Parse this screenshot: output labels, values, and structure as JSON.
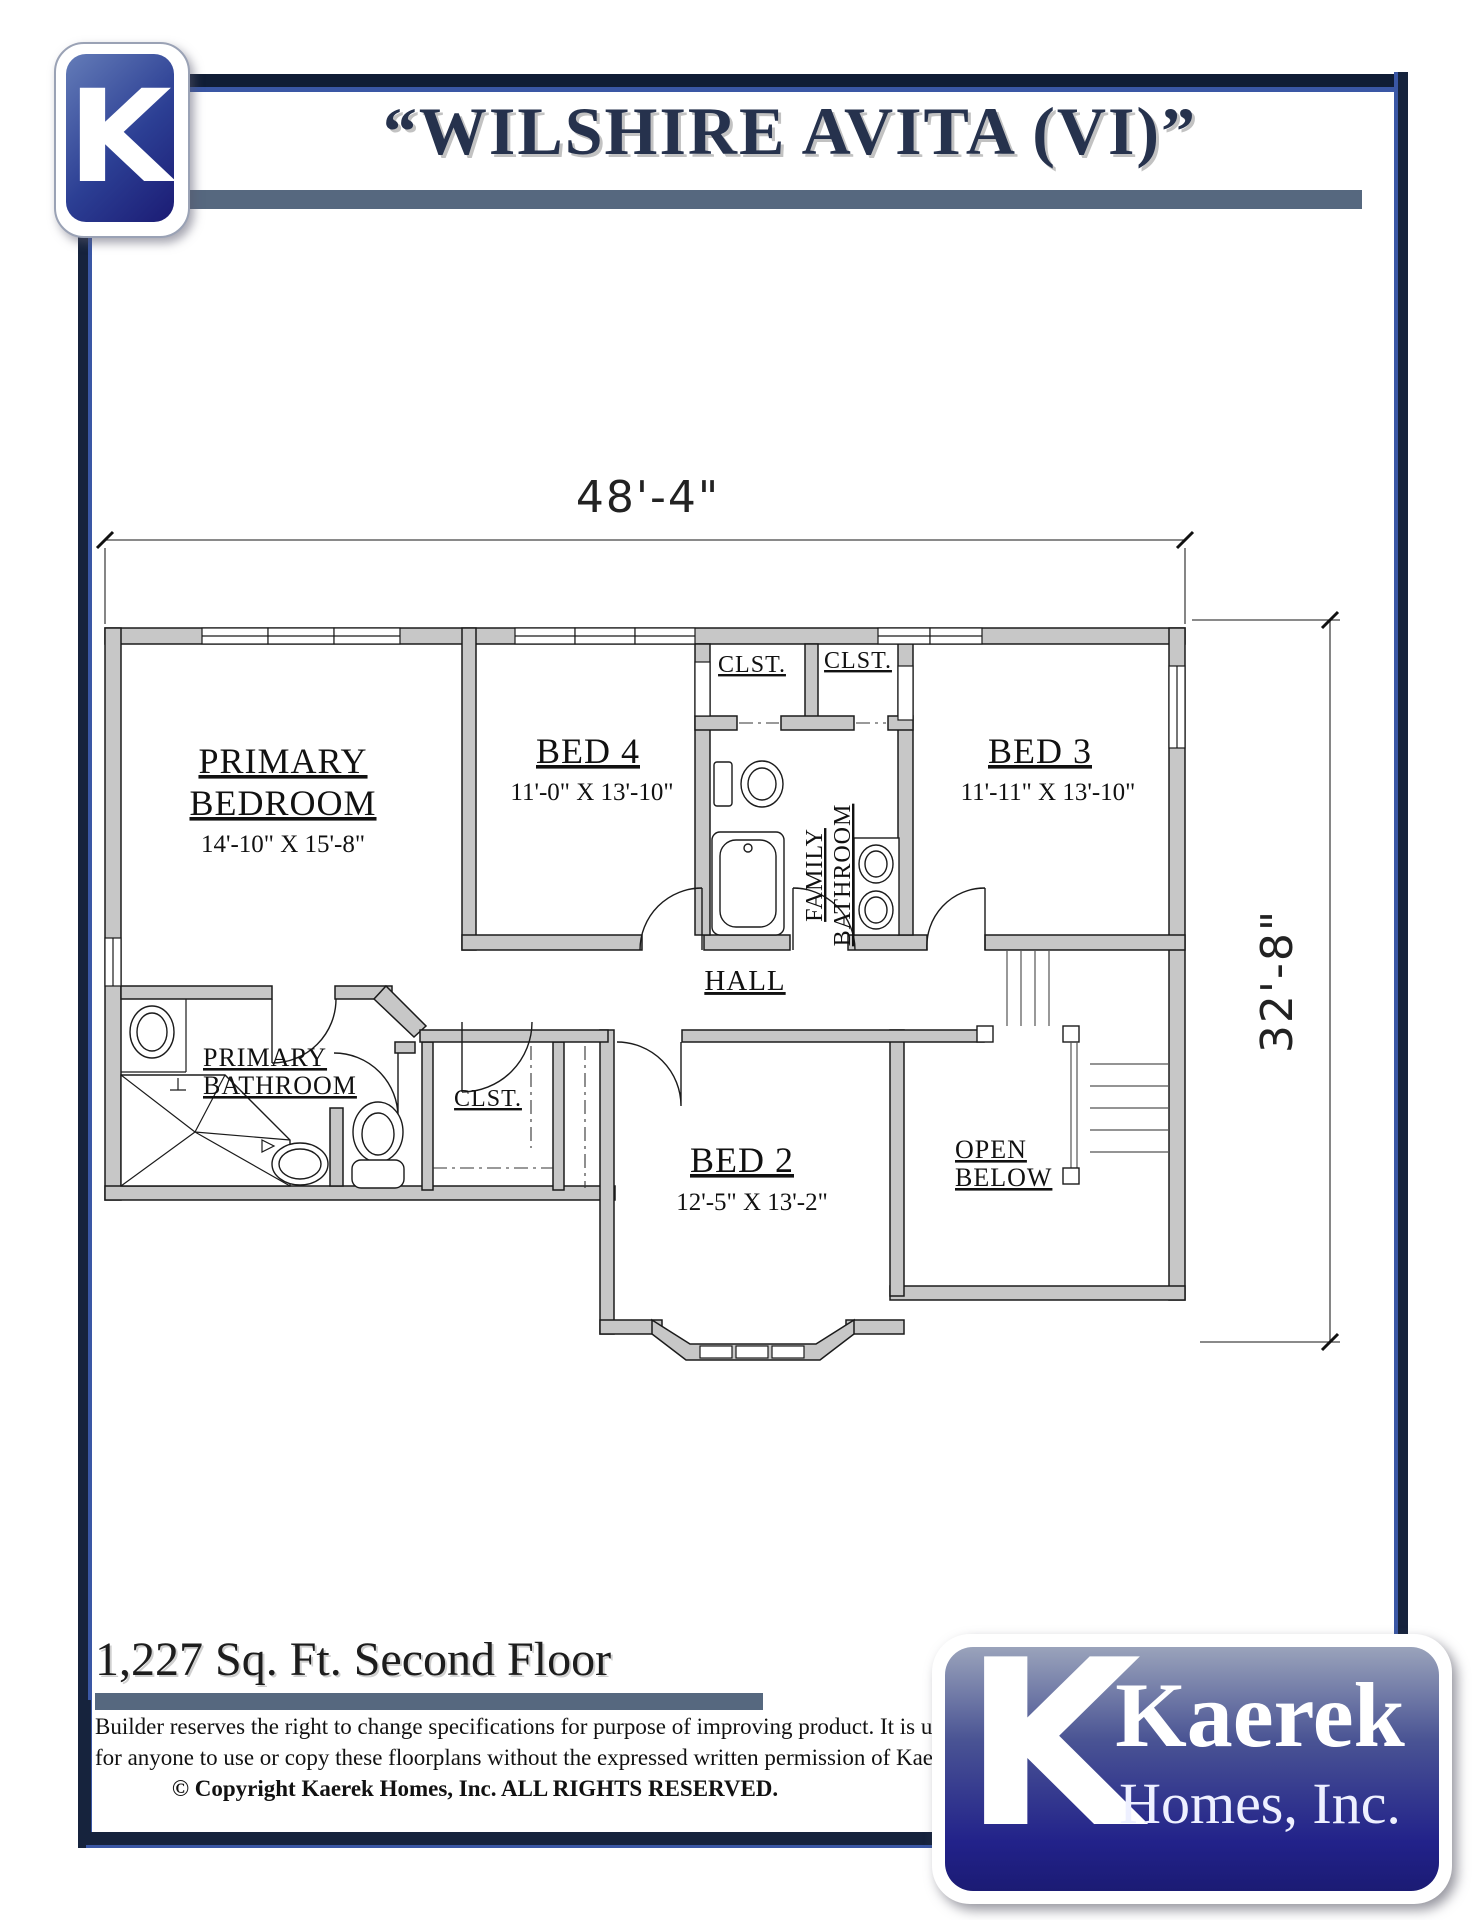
{
  "header": {
    "title": "“WILSHIRE AVITA (VI)”",
    "logo_letter": "K"
  },
  "plan": {
    "width_label": "48'-4\"",
    "height_label": "32'-8\"",
    "rooms": {
      "primary_bedroom": {
        "line1": "PRIMARY",
        "line2": "BEDROOM",
        "dims": "14'-10\" X 15'-8\""
      },
      "bed4": {
        "name": "BED 4",
        "dims": "11'-0\" X 13'-10\""
      },
      "bed3": {
        "name": "BED 3",
        "dims": "11'-11\" X 13'-10\""
      },
      "bed2": {
        "name": "BED 2",
        "dims": "12'-5\" X 13'-2\""
      },
      "primary_bathroom": {
        "line1": "PRIMARY",
        "line2": "BATHROOM"
      },
      "family_bathroom": {
        "line1": "FAMILY",
        "line2": "BATHROOM"
      },
      "hall": {
        "name": "HALL"
      },
      "closet1": {
        "name": "CLST."
      },
      "closet2": {
        "name": "CLST."
      },
      "closet3": {
        "name": "CLST."
      },
      "open_below": {
        "line1": "OPEN",
        "line2": "BELOW"
      }
    }
  },
  "footer": {
    "area_label": "1,227 Sq. Ft. Second Floor",
    "disclaimer_line1": "Builder reserves the right to change specifications for purpose of improving product.  It is unlawful",
    "disclaimer_line2": "for anyone to use or copy these floorplans without the expressed written permission of Kaerek Homes, Inc.",
    "disclaimer_line3": "© Copyright Kaerek Homes, Inc. ALL RIGHTS RESERVED."
  },
  "brand": {
    "logo_letter": "K",
    "name_line1": "Kaerek",
    "name_line2": "Homes, Inc."
  },
  "colors": {
    "navy": "#16233d",
    "royal_blue": "#3a57a5",
    "slate_bar": "#56687f",
    "wall_gray": "#c7c7c7",
    "logo_dark_blue": "#1b1b74",
    "logo_light_blue": "#647cb8"
  }
}
